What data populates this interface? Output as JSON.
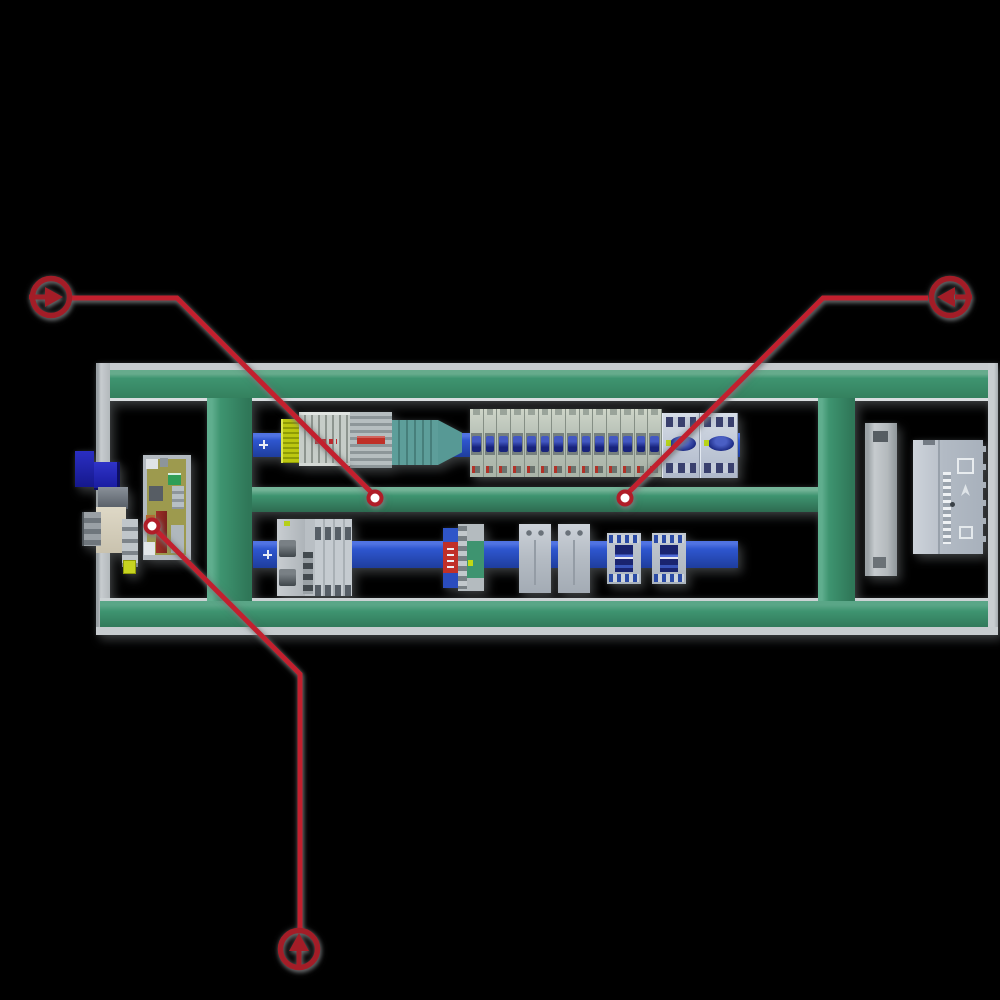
{
  "scene": {
    "subject": "electrical-control-panel-top-view"
  },
  "colors": {
    "background": "#000000",
    "frame_green": "#3e9470",
    "frame_gray": "#c7cccf",
    "din_rail_blue": "#2e56cf",
    "annotation_line_red": "#c2202e",
    "annotation_ring_red": "#a31d27",
    "annotation_dot_ring": "#b01d28",
    "marker_dot_fill": "#ffffff",
    "mcb_toggle_blue": "#18237c",
    "motor_breaker_knob": "#1b2a84",
    "terminal_yellow": "#bcc710",
    "teal_component": "#579995",
    "surge_red": "#c03028",
    "surge_blue": "#2f55c8",
    "pcb_olive": "#9d9a4e",
    "beige_plate": "#c9c2ae",
    "deep_blue_box": "#15188c"
  },
  "components": {
    "upper_rail": {
      "mcb_count": 14,
      "motor_breaker_count": 2
    },
    "lower_rail": {
      "relay_count": 2,
      "contactor_count": 2
    }
  },
  "annotations": {
    "markers": [
      {
        "id": "nav-right",
        "icon": "arrow-right-icon"
      },
      {
        "id": "nav-left",
        "icon": "arrow-left-icon"
      },
      {
        "id": "nav-up",
        "icon": "arrow-up-icon"
      }
    ],
    "target_dot_count": 3
  }
}
